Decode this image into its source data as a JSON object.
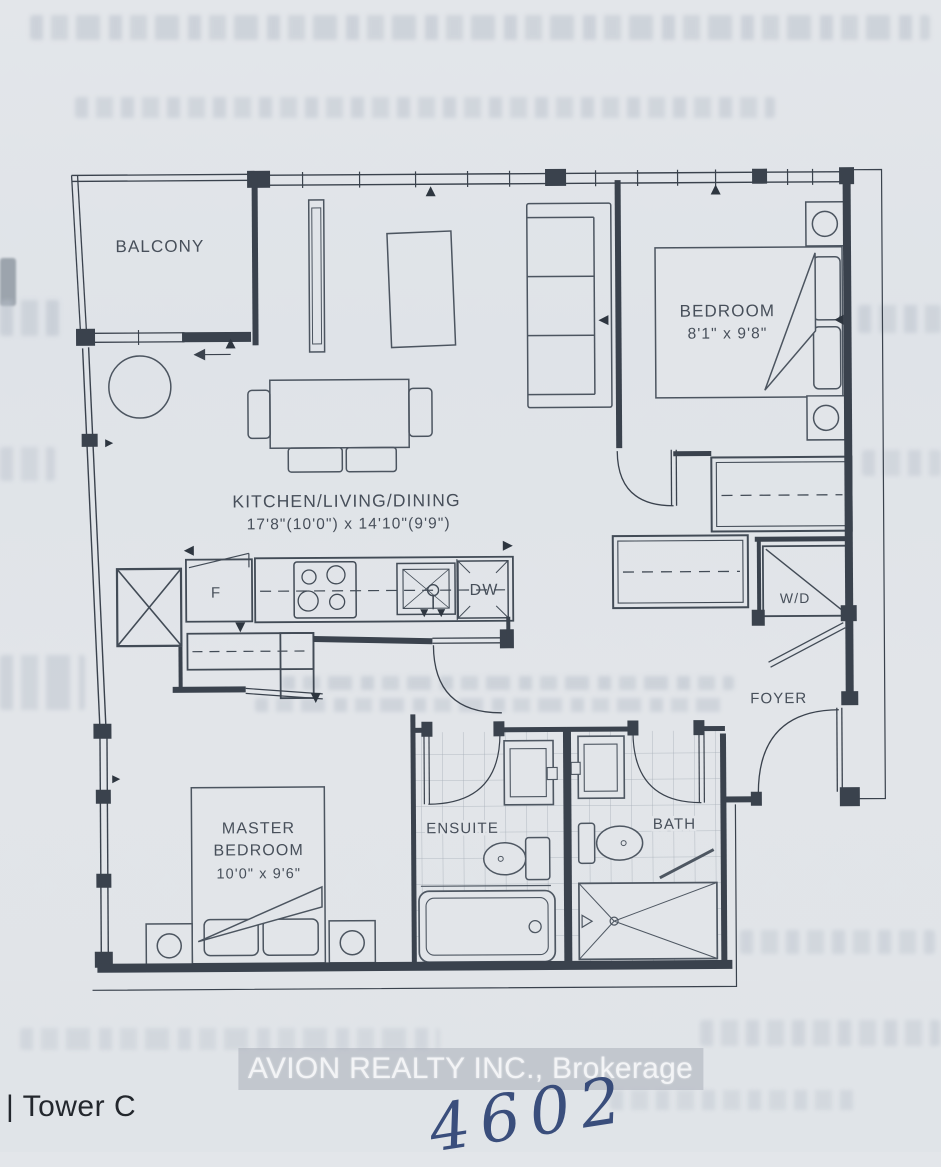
{
  "page": {
    "paper_color": "#e1e4e9",
    "line_color": "#3a424d",
    "ink_color": "#2d4273"
  },
  "floorplan": {
    "balcony": {
      "label": "BALCONY"
    },
    "bedroom": {
      "label": "BEDROOM",
      "dimensions": "8'1\" x 9'8\""
    },
    "kitchen_living_dining": {
      "label": "KITCHEN/LIVING/DINING",
      "dimensions": "17'8\"(10'0\") x 14'10\"(9'9\")"
    },
    "master_bedroom": {
      "label_line_1": "MASTER",
      "label_line_2": "BEDROOM",
      "dimensions": "10'0\" x 9'6\""
    },
    "ensuite": {
      "label": "ENSUITE"
    },
    "bath": {
      "label": "BATH"
    },
    "foyer": {
      "label": "FOYER"
    },
    "washer_dryer": {
      "label": "W/D"
    },
    "fridge": {
      "label": "F"
    },
    "dishwasher": {
      "label": "DW"
    }
  },
  "footer": {
    "tower_label": "| Tower C",
    "watermark": "AVION REALTY INC., Brokerage",
    "handwritten_unit_number": "4602"
  }
}
